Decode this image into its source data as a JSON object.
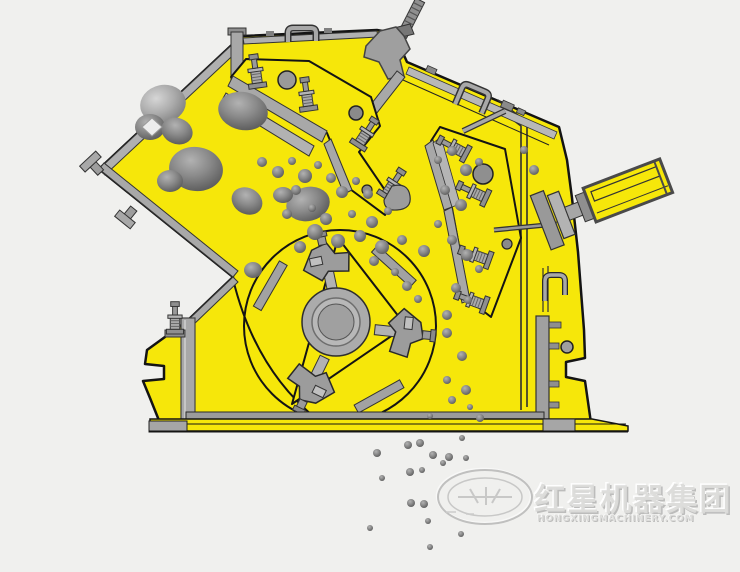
{
  "figure": {
    "description": "Cross-section technical illustration of an impact crusher: yellow housing, rotor with blow bars, two impact aprons with spring bolts, hydraulic cylinder, rocks being fed in and crushed particles falling out"
  },
  "colors": {
    "background": "#f0f0ee",
    "machine_yellow": "#f6e70a",
    "outline": "#141414",
    "steel_light": "#c6c6c6",
    "steel_mid": "#a6a6a6",
    "steel_dark": "#7a7a7a",
    "rock_gray": "#8b8b8b"
  },
  "watermark": {
    "logo": "oval-star-emblem",
    "text_cn": "红星机器集团",
    "text_en": "HONGXINGMACHINERY.COM"
  },
  "rocks": {
    "feed": [
      [
        163,
        104,
        23,
        19,
        -12,
        0
      ],
      [
        150,
        127,
        15,
        13,
        0,
        1
      ],
      [
        177,
        131,
        16,
        13,
        22,
        1
      ],
      [
        243,
        111,
        25,
        19,
        12,
        1
      ],
      [
        196,
        169,
        27,
        22,
        8,
        1
      ],
      [
        170,
        181,
        13,
        11,
        0,
        1
      ],
      [
        247,
        201,
        16,
        13,
        28,
        1
      ],
      [
        308,
        204,
        22,
        17,
        -14,
        1
      ],
      [
        283,
        195,
        10,
        8,
        0,
        1
      ],
      [
        253,
        270,
        9,
        8,
        0,
        1
      ]
    ],
    "mid": [
      [
        262,
        162,
        5
      ],
      [
        278,
        172,
        6
      ],
      [
        292,
        161,
        4
      ],
      [
        305,
        176,
        7
      ],
      [
        318,
        165,
        4
      ],
      [
        331,
        178,
        5
      ],
      [
        296,
        190,
        5
      ],
      [
        342,
        192,
        6
      ],
      [
        356,
        181,
        4
      ],
      [
        368,
        194,
        5
      ],
      [
        312,
        208,
        4
      ],
      [
        326,
        219,
        6
      ],
      [
        352,
        214,
        4
      ],
      [
        372,
        222,
        6
      ],
      [
        388,
        211,
        4
      ],
      [
        315,
        232,
        8
      ],
      [
        338,
        241,
        7
      ],
      [
        360,
        236,
        6
      ],
      [
        382,
        247,
        7
      ],
      [
        402,
        240,
        5
      ],
      [
        424,
        251,
        6
      ],
      [
        300,
        247,
        6
      ],
      [
        287,
        214,
        5
      ],
      [
        374,
        261,
        5
      ],
      [
        395,
        272,
        4
      ],
      [
        407,
        286,
        5
      ],
      [
        418,
        299,
        4
      ],
      [
        438,
        160,
        4
      ],
      [
        452,
        151,
        5
      ],
      [
        466,
        170,
        6
      ],
      [
        479,
        162,
        4
      ],
      [
        445,
        190,
        5
      ],
      [
        461,
        205,
        6
      ],
      [
        438,
        224,
        4
      ],
      [
        452,
        240,
        5
      ],
      [
        467,
        255,
        6
      ],
      [
        479,
        269,
        4
      ],
      [
        456,
        288,
        5
      ],
      [
        468,
        300,
        4
      ],
      [
        447,
        315,
        5
      ],
      [
        524,
        150,
        4
      ],
      [
        534,
        170,
        5
      ],
      [
        447,
        333,
        5
      ],
      [
        462,
        356,
        5
      ],
      [
        447,
        380,
        4
      ],
      [
        466,
        390,
        5
      ],
      [
        480,
        418,
        4
      ],
      [
        452,
        400,
        4
      ],
      [
        430,
        416,
        3
      ],
      [
        470,
        407,
        3
      ]
    ],
    "out": [
      [
        377,
        453,
        4
      ],
      [
        408,
        445,
        4
      ],
      [
        420,
        443,
        4
      ],
      [
        433,
        455,
        4
      ],
      [
        449,
        457,
        4
      ],
      [
        466,
        458,
        3
      ],
      [
        462,
        438,
        3
      ],
      [
        410,
        472,
        4
      ],
      [
        422,
        470,
        3
      ],
      [
        411,
        503,
        4
      ],
      [
        424,
        504,
        4
      ],
      [
        370,
        528,
        3
      ],
      [
        430,
        547,
        3
      ],
      [
        443,
        463,
        3
      ],
      [
        461,
        534,
        3
      ],
      [
        428,
        521,
        3
      ],
      [
        382,
        478,
        3
      ]
    ]
  }
}
